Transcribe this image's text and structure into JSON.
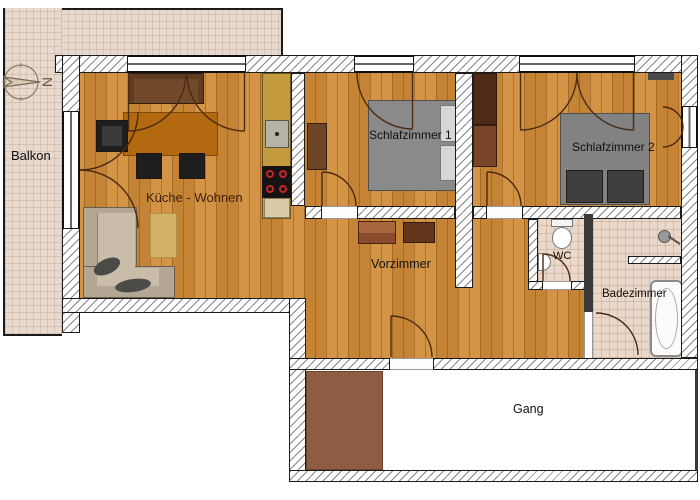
{
  "plan_type": "apartment floor plan",
  "rooms": {
    "balcony": {
      "label": "Balkon"
    },
    "kitchen_living": {
      "label": "Küche - Wohnen"
    },
    "bedroom1": {
      "label": "Schlafzimmer 1"
    },
    "bedroom2": {
      "label": "Schlafzimmer 2"
    },
    "hallway": {
      "label": "Vorzimmer"
    },
    "wc": {
      "label": "WC"
    },
    "bathroom": {
      "label": "Badezimmer"
    },
    "corridor": {
      "label": "Gang"
    }
  },
  "compass": {
    "letter": "N"
  },
  "colors": {
    "wood_floor": "#d18c38",
    "balcony_tile": "#e7d9cd",
    "bath_tile": "#ead9cb",
    "wall_fill": "#ffffff",
    "wall_line": "#1b1b1b",
    "bed_gray": "#8a8a8a",
    "dark_pillow": "#3f3f3f",
    "table_brown": "#b2690f",
    "sofa_dark_brown": "#5f3c22",
    "corner_sofa_beige": "#b3a692",
    "counter_mustard": "#c49a3f",
    "stove_black": "#141414",
    "burner_red": "#cc2425",
    "wardrobe_brown": "#6f4527",
    "corridor_mat": "#8d5c42",
    "label_dark": "#111111",
    "kitchen_label": "#3c1f0c"
  }
}
